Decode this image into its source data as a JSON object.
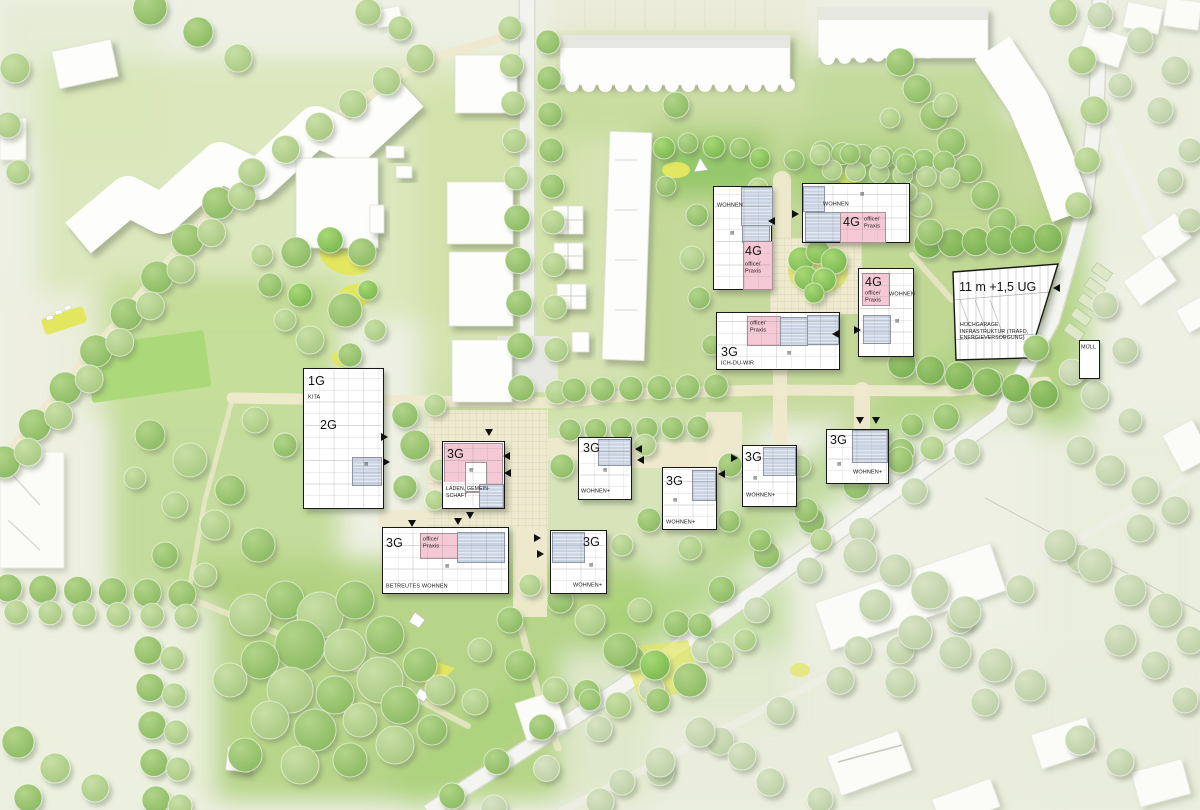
{
  "annotations": {
    "wohnen": "WOHNEN",
    "wohnen_plus": "WOHNEN+",
    "g1": "1G",
    "g2": "2G",
    "g3": "3G",
    "g4": "4G",
    "office1": "office/",
    "office2": "Praxis",
    "kita": "KITA",
    "ich_du_wir": "ICH-DU-WIR",
    "laeden1": "LÄDEN, GEMEIN-",
    "laeden2": "SCHAFT",
    "betreutes": "BETREUTES WOHNEN",
    "garage_height": "11 m +1,5 UG",
    "garage1": "HOCHGARAGE",
    "garage2": "INFRASTRUKTUR (TRAFO,",
    "garage3": "ENERGIEVERSORGUNG)",
    "muell": "MÜLL"
  },
  "icons": {
    "skylight": "⊠"
  },
  "colors": {
    "residential_roof_blue": "#c9d2e2",
    "special_use_pink": "#f4c8d4",
    "new_building_outline": "#181818",
    "path_cream": "#efe9cd",
    "grass_bright": "#a8d276",
    "grass_pale_outside": "#edf0e3",
    "play_yellow": "#e3e75f"
  },
  "map": {
    "tree_rows": [
      {
        "x1": 4,
        "y1": 462,
        "x2": 218,
        "y2": 203,
        "n": 8,
        "r": 16,
        "t": "m"
      },
      {
        "x1": 28,
        "y1": 452,
        "x2": 242,
        "y2": 196,
        "n": 8,
        "r": 14,
        "t": "l"
      },
      {
        "x1": 252,
        "y1": 172,
        "x2": 420,
        "y2": 58,
        "n": 6,
        "r": 14,
        "t": "l"
      },
      {
        "x1": 510,
        "y1": 28,
        "x2": 516,
        "y2": 178,
        "n": 5,
        "r": 12,
        "t": "l"
      },
      {
        "x1": 548,
        "y1": 42,
        "x2": 552,
        "y2": 186,
        "n": 5,
        "r": 12,
        "t": "m"
      },
      {
        "x1": 517,
        "y1": 218,
        "x2": 521,
        "y2": 388,
        "n": 5,
        "r": 13,
        "t": "m"
      },
      {
        "x1": 553,
        "y1": 222,
        "x2": 557,
        "y2": 392,
        "n": 5,
        "r": 12,
        "t": "l"
      },
      {
        "x1": 570,
        "y1": 430,
        "x2": 698,
        "y2": 427,
        "n": 6,
        "r": 11,
        "t": "m"
      },
      {
        "x1": 452,
        "y1": 796,
        "x2": 1036,
        "y2": 348,
        "n": 14,
        "r": 13,
        "t": "m"
      },
      {
        "x1": 494,
        "y1": 808,
        "x2": 1072,
        "y2": 372,
        "n": 12,
        "r": 13,
        "t": "p"
      },
      {
        "x1": 600,
        "y1": 802,
        "x2": 1140,
        "y2": 528,
        "n": 10,
        "r": 14,
        "t": "p"
      },
      {
        "x1": 900,
        "y1": 62,
        "x2": 1002,
        "y2": 222,
        "n": 7,
        "r": 14,
        "t": "m"
      },
      {
        "x1": 928,
        "y1": 244,
        "x2": 1048,
        "y2": 238,
        "n": 6,
        "r": 14,
        "t": "d"
      },
      {
        "x1": 8,
        "y1": 588,
        "x2": 182,
        "y2": 594,
        "n": 6,
        "r": 14,
        "t": "m"
      },
      {
        "x1": 16,
        "y1": 612,
        "x2": 186,
        "y2": 616,
        "n": 6,
        "r": 12,
        "t": "l"
      },
      {
        "x1": 148,
        "y1": 650,
        "x2": 156,
        "y2": 800,
        "n": 5,
        "r": 14,
        "t": "m"
      },
      {
        "x1": 172,
        "y1": 658,
        "x2": 180,
        "y2": 806,
        "n": 5,
        "r": 12,
        "t": "l"
      },
      {
        "x1": 822,
        "y1": 152,
        "x2": 944,
        "y2": 162,
        "n": 7,
        "r": 11,
        "t": "m"
      },
      {
        "x1": 832,
        "y1": 170,
        "x2": 950,
        "y2": 178,
        "n": 6,
        "r": 10,
        "t": "l"
      },
      {
        "x1": 574,
        "y1": 390,
        "x2": 716,
        "y2": 386,
        "n": 6,
        "r": 12,
        "t": "m"
      },
      {
        "x1": 902,
        "y1": 364,
        "x2": 1044,
        "y2": 394,
        "n": 6,
        "r": 14,
        "t": "d"
      }
    ],
    "trees": [
      [
        15,
        68,
        15,
        "l"
      ],
      [
        8,
        125,
        13,
        "l"
      ],
      [
        18,
        172,
        12,
        "l"
      ],
      [
        150,
        8,
        17,
        "m"
      ],
      [
        198,
        32,
        15,
        "m"
      ],
      [
        238,
        58,
        14,
        "l"
      ],
      [
        368,
        12,
        13,
        "l"
      ],
      [
        400,
        28,
        12,
        "l"
      ],
      [
        1063,
        12,
        14,
        "l"
      ],
      [
        1082,
        60,
        14,
        "l"
      ],
      [
        1094,
        110,
        14,
        "l"
      ],
      [
        1087,
        160,
        13,
        "l"
      ],
      [
        1078,
        205,
        13,
        "l"
      ],
      [
        1100,
        15,
        13,
        "p"
      ],
      [
        1140,
        40,
        13,
        "p"
      ],
      [
        1175,
        70,
        14,
        "p"
      ],
      [
        1120,
        85,
        12,
        "p"
      ],
      [
        1160,
        110,
        13,
        "p"
      ],
      [
        1190,
        150,
        12,
        "p"
      ],
      [
        1170,
        180,
        13,
        "p"
      ],
      [
        1190,
        220,
        12,
        "p"
      ],
      [
        1105,
        305,
        13,
        "p"
      ],
      [
        1125,
        350,
        13,
        "p"
      ],
      [
        1095,
        395,
        14,
        "p"
      ],
      [
        1130,
        420,
        12,
        "p"
      ],
      [
        1080,
        450,
        14,
        "p"
      ],
      [
        1110,
        470,
        15,
        "p"
      ],
      [
        1145,
        490,
        14,
        "p"
      ],
      [
        1175,
        510,
        14,
        "p"
      ],
      [
        1060,
        545,
        16,
        "p"
      ],
      [
        1095,
        565,
        17,
        "p"
      ],
      [
        1130,
        590,
        16,
        "p"
      ],
      [
        1165,
        610,
        17,
        "p"
      ],
      [
        1190,
        640,
        14,
        "p"
      ],
      [
        1120,
        640,
        16,
        "p"
      ],
      [
        1155,
        665,
        14,
        "p"
      ],
      [
        1185,
        700,
        13,
        "p"
      ],
      [
        860,
        555,
        17,
        "p"
      ],
      [
        895,
        570,
        16,
        "p"
      ],
      [
        930,
        590,
        19,
        "p"
      ],
      [
        965,
        612,
        16,
        "p"
      ],
      [
        875,
        605,
        16,
        "p"
      ],
      [
        915,
        632,
        17,
        "p"
      ],
      [
        955,
        652,
        16,
        "p"
      ],
      [
        995,
        665,
        17,
        "p"
      ],
      [
        1030,
        685,
        16,
        "p"
      ],
      [
        985,
        702,
        14,
        "p"
      ],
      [
        900,
        682,
        15,
        "p"
      ],
      [
        858,
        650,
        14,
        "p"
      ],
      [
        1080,
        740,
        15,
        "p"
      ],
      [
        1120,
        762,
        14,
        "p"
      ],
      [
        770,
        782,
        14,
        "p"
      ],
      [
        820,
        800,
        13,
        "p"
      ],
      [
        700,
        732,
        15,
        "p"
      ],
      [
        742,
        756,
        14,
        "p"
      ],
      [
        660,
        762,
        15,
        "p"
      ],
      [
        622,
        782,
        13,
        "p"
      ],
      [
        18,
        742,
        16,
        "m"
      ],
      [
        55,
        768,
        15,
        "l"
      ],
      [
        28,
        798,
        14,
        "m"
      ],
      [
        95,
        788,
        14,
        "l"
      ],
      [
        150,
        435,
        15,
        "m"
      ],
      [
        190,
        460,
        17,
        "l"
      ],
      [
        230,
        490,
        15,
        "m"
      ],
      [
        175,
        505,
        13,
        "l"
      ],
      [
        215,
        525,
        15,
        "l"
      ],
      [
        258,
        545,
        17,
        "m"
      ],
      [
        165,
        555,
        13,
        "m"
      ],
      [
        205,
        575,
        12,
        "l"
      ],
      [
        135,
        478,
        11,
        "l"
      ],
      [
        255,
        420,
        13,
        "l"
      ],
      [
        285,
        445,
        12,
        "m"
      ],
      [
        296,
        252,
        15,
        "m"
      ],
      [
        330,
        240,
        13,
        "b"
      ],
      [
        362,
        252,
        14,
        "m"
      ],
      [
        300,
        295,
        12,
        "b"
      ],
      [
        345,
        310,
        17,
        "m"
      ],
      [
        310,
        340,
        14,
        "l"
      ],
      [
        350,
        355,
        12,
        "m"
      ],
      [
        285,
        320,
        11,
        "l"
      ],
      [
        375,
        330,
        11,
        "l"
      ],
      [
        368,
        290,
        10,
        "b"
      ],
      [
        270,
        285,
        12,
        "m"
      ],
      [
        262,
        255,
        11,
        "l"
      ],
      [
        405,
        415,
        13,
        "m"
      ],
      [
        435,
        405,
        11,
        "l"
      ],
      [
        415,
        445,
        15,
        "m"
      ],
      [
        440,
        470,
        11,
        "l"
      ],
      [
        405,
        487,
        12,
        "m"
      ],
      [
        435,
        500,
        10,
        "l"
      ],
      [
        250,
        615,
        21,
        "l"
      ],
      [
        285,
        600,
        19,
        "m"
      ],
      [
        320,
        615,
        23,
        "l"
      ],
      [
        355,
        600,
        19,
        "m"
      ],
      [
        300,
        645,
        25,
        "m"
      ],
      [
        345,
        650,
        21,
        "l"
      ],
      [
        385,
        635,
        19,
        "m"
      ],
      [
        260,
        660,
        19,
        "m"
      ],
      [
        230,
        680,
        17,
        "l"
      ],
      [
        290,
        690,
        23,
        "l"
      ],
      [
        335,
        695,
        19,
        "m"
      ],
      [
        380,
        680,
        23,
        "l"
      ],
      [
        420,
        665,
        17,
        "m"
      ],
      [
        270,
        720,
        19,
        "l"
      ],
      [
        315,
        730,
        21,
        "m"
      ],
      [
        360,
        720,
        17,
        "l"
      ],
      [
        400,
        705,
        19,
        "m"
      ],
      [
        245,
        755,
        17,
        "m"
      ],
      [
        300,
        765,
        19,
        "l"
      ],
      [
        350,
        760,
        17,
        "m"
      ],
      [
        395,
        745,
        19,
        "l"
      ],
      [
        440,
        690,
        15,
        "l"
      ],
      [
        432,
        730,
        15,
        "m"
      ],
      [
        475,
        702,
        13,
        "l"
      ],
      [
        560,
        600,
        13,
        "m"
      ],
      [
        590,
        620,
        15,
        "l"
      ],
      [
        620,
        650,
        17,
        "m"
      ],
      [
        655,
        665,
        15,
        "b"
      ],
      [
        690,
        680,
        17,
        "m"
      ],
      [
        720,
        655,
        13,
        "l"
      ],
      [
        700,
        625,
        12,
        "m"
      ],
      [
        745,
        640,
        11,
        "l"
      ],
      [
        640,
        610,
        12,
        "l"
      ],
      [
        530,
        585,
        11,
        "l"
      ],
      [
        510,
        620,
        13,
        "m"
      ],
      [
        480,
        650,
        12,
        "l"
      ],
      [
        520,
        665,
        15,
        "m"
      ],
      [
        555,
        690,
        13,
        "l"
      ],
      [
        590,
        700,
        11,
        "m"
      ],
      [
        618,
        705,
        13,
        "l"
      ],
      [
        658,
        700,
        12,
        "m"
      ],
      [
        676,
        105,
        13,
        "m"
      ],
      [
        697,
        215,
        11,
        "m"
      ],
      [
        692,
        258,
        12,
        "l"
      ],
      [
        699,
        298,
        11,
        "m"
      ],
      [
        712,
        345,
        10,
        "m"
      ],
      [
        920,
        205,
        12,
        "l"
      ],
      [
        930,
        232,
        13,
        "m"
      ],
      [
        873,
        222,
        12,
        "l"
      ],
      [
        945,
        105,
        12,
        "l"
      ],
      [
        890,
        118,
        10,
        "l"
      ],
      [
        801,
        260,
        13,
        "b"
      ],
      [
        818,
        252,
        12,
        "b"
      ],
      [
        834,
        261,
        13,
        "b"
      ],
      [
        806,
        278,
        12,
        "b"
      ],
      [
        824,
        280,
        12,
        "b"
      ],
      [
        814,
        293,
        10,
        "b"
      ],
      [
        664,
        148,
        11,
        "b"
      ],
      [
        688,
        143,
        10,
        "m"
      ],
      [
        714,
        147,
        11,
        "b"
      ],
      [
        740,
        148,
        10,
        "m"
      ],
      [
        760,
        158,
        10,
        "b"
      ],
      [
        666,
        186,
        10,
        "m"
      ],
      [
        758,
        188,
        10,
        "l"
      ],
      [
        794,
        160,
        10,
        "m"
      ],
      [
        820,
        155,
        10,
        "l"
      ],
      [
        850,
        154,
        10,
        "m"
      ],
      [
        880,
        158,
        10,
        "l"
      ],
      [
        906,
        164,
        10,
        "m"
      ],
      [
        908,
        192,
        9,
        "l"
      ],
      [
        562,
        466,
        12,
        "m"
      ],
      [
        645,
        445,
        11,
        "l"
      ],
      [
        649,
        520,
        12,
        "m"
      ],
      [
        622,
        545,
        11,
        "l"
      ],
      [
        730,
        465,
        12,
        "m"
      ],
      [
        729,
        521,
        11,
        "m"
      ],
      [
        800,
        466,
        11,
        "l"
      ],
      [
        806,
        510,
        12,
        "m"
      ],
      [
        821,
        540,
        11,
        "l"
      ],
      [
        900,
        460,
        13,
        "m"
      ],
      [
        932,
        448,
        12,
        "l"
      ],
      [
        760,
        540,
        11,
        "m"
      ],
      [
        690,
        548,
        12,
        "l"
      ],
      [
        912,
        425,
        11,
        "m"
      ]
    ],
    "scallops": [
      {
        "x1": 572,
        "y1": 85,
        "x2": 788,
        "y2": 85,
        "n": 14,
        "r": 7
      },
      {
        "x1": 828,
        "y1": 58,
        "x2": 978,
        "y2": 48,
        "n": 10,
        "r": 7
      }
    ],
    "entrance_arrows": [
      [
        772,
        221,
        "left"
      ],
      [
        796,
        214,
        "right"
      ],
      [
        836,
        334,
        "left"
      ],
      [
        858,
        330,
        "right"
      ],
      [
        860,
        421,
        "down"
      ],
      [
        876,
        421,
        "down"
      ],
      [
        385,
        437,
        "right"
      ],
      [
        387,
        462,
        "right"
      ],
      [
        489,
        433,
        "down"
      ],
      [
        507,
        456,
        "left"
      ],
      [
        508,
        473,
        "left"
      ],
      [
        470,
        516,
        "down"
      ],
      [
        639,
        449,
        "left"
      ],
      [
        641,
        460,
        "left"
      ],
      [
        735,
        458,
        "right"
      ],
      [
        722,
        474,
        "left"
      ],
      [
        538,
        538,
        "right"
      ],
      [
        541,
        554,
        "right"
      ],
      [
        412,
        524,
        "down"
      ],
      [
        458,
        522,
        "down"
      ],
      [
        1057,
        288,
        "left"
      ]
    ]
  }
}
